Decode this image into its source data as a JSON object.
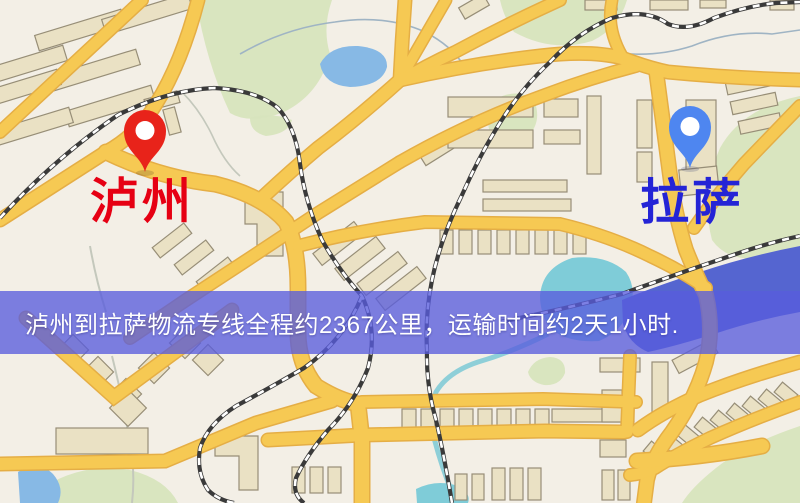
{
  "map": {
    "banner": {
      "text": "泸州到拉萨物流专线全程约2367公里，运输时间约2天1小时.",
      "distance_km": "2367",
      "duration_text": "2天1小时",
      "background": "#5a5edd",
      "text_color": "#ffffff"
    },
    "origin_marker": {
      "label": "泸州",
      "pin_color": "#e8231a",
      "label_color": "#e60013"
    },
    "destination_marker": {
      "label": "拉萨",
      "pin_color": "#4e86f0",
      "label_color": "#2424d6"
    },
    "palette": {
      "map_background": "#f3efe6",
      "road": "#f6c953",
      "road_edge": "#e5ae45",
      "park": "#d7e4bd",
      "lake": "#87b9e5",
      "river": "#5565d0",
      "teal_water": "#7fccd8",
      "railway": "#3a3a3a",
      "building_fill": "#eae1c4",
      "building_outline": "#978e77"
    }
  }
}
